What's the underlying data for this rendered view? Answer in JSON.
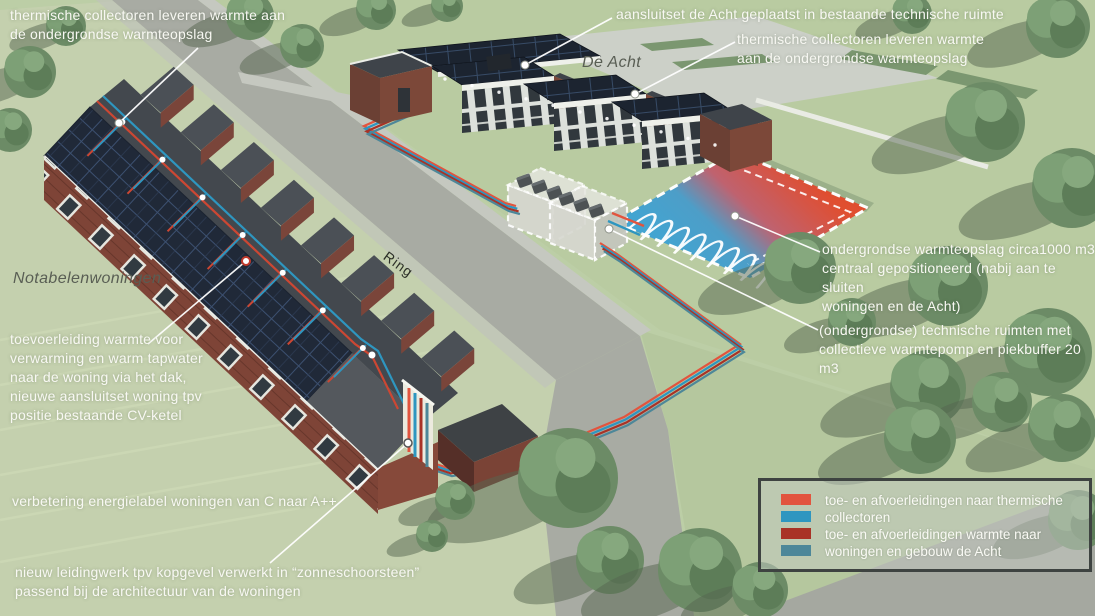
{
  "labels": {
    "school": "De Acht",
    "houses": "Notabelenwoningen",
    "road": "Ring"
  },
  "annotations": {
    "collectors_left": "thermische collectoren leveren warmte aan\nde ondergrondse warmteopslag",
    "aansluitset_acht": "aansluitset de Acht geplaatst in bestaande technische ruimte",
    "collectors_right": "thermische collectoren leveren warmte\naan de ondergrondse warmteopslag",
    "storage": "ondergrondse warmteopslag circa1000 m3\ncentraal gepositioneerd (nabij aan te sluiten\nwoningen en de Acht)",
    "tech_rooms": "(ondergrondse) technische ruimten met\ncollectieve warmtepomp en piekbuffer 20 m3",
    "supply_line": "toevoerleiding warmte voor\nverwarming en warm tapwater\nnaar de woning via het dak,\nnieuwe aansluitset woning tpv\npositie bestaande CV-ketel",
    "energy_label": "verbetering energielabel woningen van C naar A++",
    "pipework": "nieuw leidingwerk tpv kopgevel verwerkt in “zonneschoorsteen”\npassend bij de architectuur van de woningen"
  },
  "legend": {
    "items": [
      {
        "color": "#e2543e",
        "label": "toe- en afvoerleidingen naar thermische"
      },
      {
        "color": "#2e96c0",
        "label": "collectoren"
      },
      {
        "color": "#a93226",
        "label": "toe- en afvoerleidingen warmte naar"
      },
      {
        "color": "#4d8799",
        "label": "woningen en gebouw de Acht"
      }
    ]
  },
  "colors": {
    "storage_hot": "#e24b2d",
    "storage_cold": "#3fa3d3"
  }
}
